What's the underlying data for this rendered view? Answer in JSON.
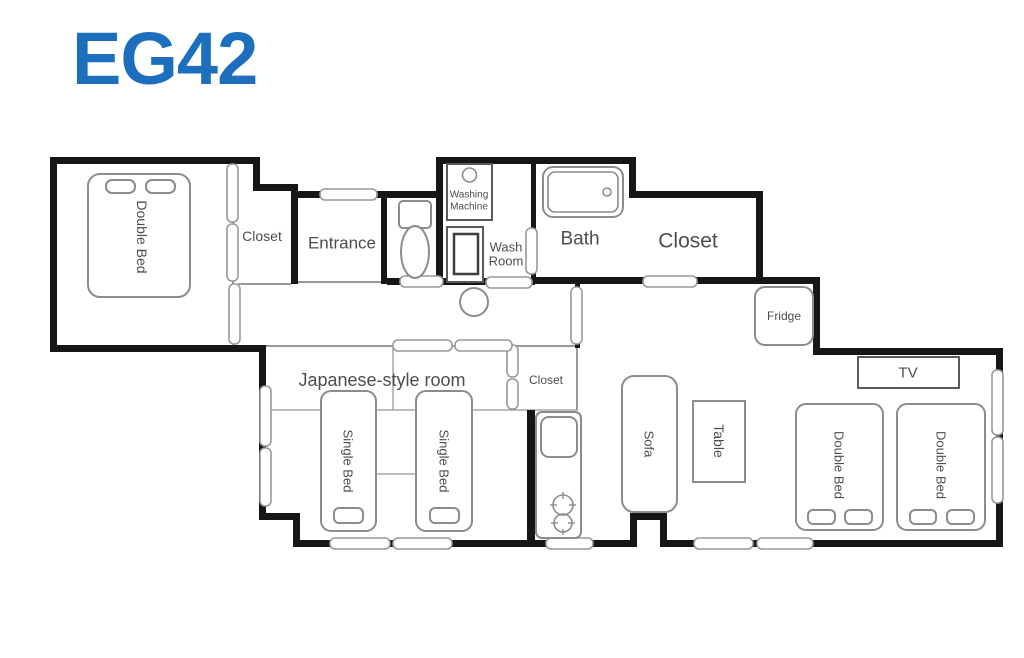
{
  "title": "EG42",
  "colors": {
    "title_blue": "#1d6fbe",
    "wall_black": "#161616",
    "furniture_gray": "#8c8c8c",
    "label_gray": "#4d4d4d"
  },
  "floorplan": {
    "rooms": {
      "bedroom_double_bed": "Double Bed",
      "closet_top_left": "Closet",
      "entrance": "Entrance",
      "washing_line1": "Washing",
      "washing_line2": "Machine",
      "washroom_line1": "Wash",
      "washroom_line2": "Room",
      "bath": "Bath",
      "closet_top_right": "Closet",
      "fridge": "Fridge",
      "japanese_room": "Japanese-style room",
      "closet_middle": "Closet",
      "single_bed_1": "Single Bed",
      "single_bed_2": "Single Bed",
      "sofa": "Sofa",
      "table": "Table",
      "tv": "TV",
      "double_bed_1": "Double Bed",
      "double_bed_2": "Double Bed"
    }
  }
}
